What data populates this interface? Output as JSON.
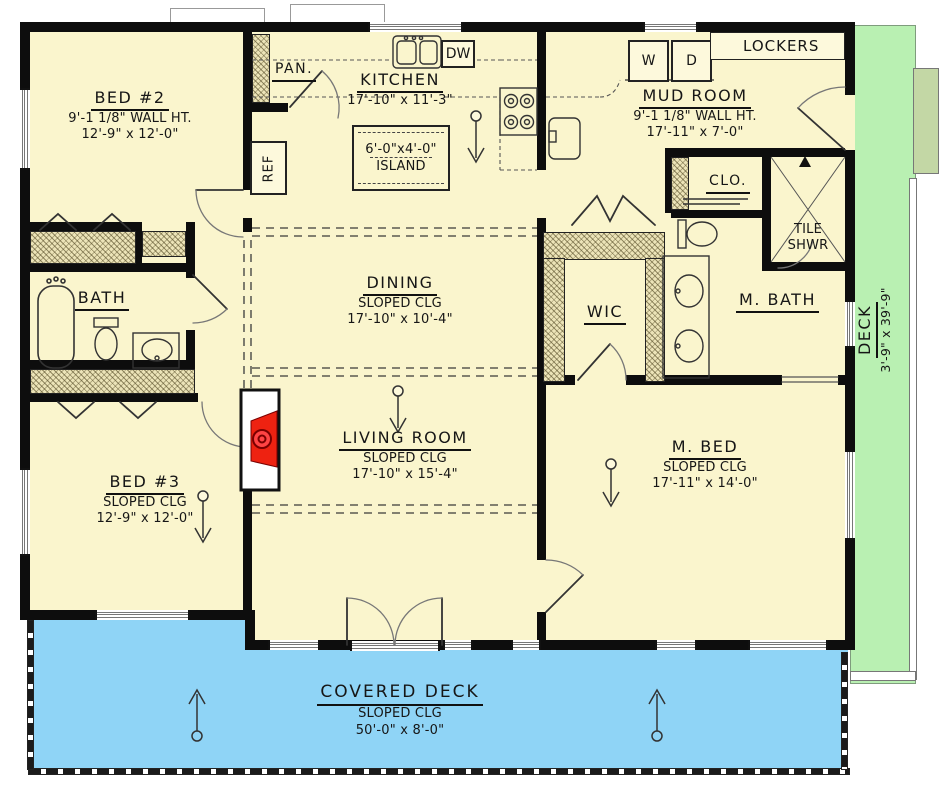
{
  "plan": {
    "title": "One-story house floor plan",
    "colors": {
      "floor": "#faf5cd",
      "wall": "#0d0d0d",
      "deck": "#b9f0b2",
      "deck_step": "#c3d7a5",
      "covered_deck": "#8fd4f6",
      "fireplace": "#ee2211",
      "hatch": "#ece4b8"
    },
    "rooms": {
      "bed2": {
        "name": "BED #2",
        "line1": "9'-1 1/8\" WALL HT.",
        "line2": "12'-9\" x 12'-0\""
      },
      "kitchen": {
        "name": "KITCHEN",
        "line1": "17'-10\" x 11'-3\""
      },
      "island": {
        "line1": "6'-0\"x4'-0\"",
        "line2": "ISLAND"
      },
      "mudroom": {
        "name": "MUD ROOM",
        "line1": "9'-1 1/8\" WALL HT.",
        "line2": "17'-11\" x 7'-0\""
      },
      "dining": {
        "name": "DINING",
        "line1": "SLOPED CLG",
        "line2": "17'-10\" x 10'-4\""
      },
      "living": {
        "name": "LIVING ROOM",
        "line1": "SLOPED CLG",
        "line2": "17'-10\" x 15'-4\""
      },
      "bed3": {
        "name": "BED #3",
        "line1": "SLOPED CLG",
        "line2": "12'-9\" x 12'-0\""
      },
      "mbed": {
        "name": "M. BED",
        "line1": "SLOPED CLG",
        "line2": "17'-11\" x 14'-0\""
      },
      "bath": {
        "name": "BATH"
      },
      "mbath": {
        "name": "M. BATH"
      },
      "wic": {
        "name": "WIC"
      },
      "clo": {
        "name": "CLO."
      },
      "pan": {
        "name": "PAN."
      },
      "tile_shwr": {
        "line1": "TILE",
        "line2": "SHWR"
      },
      "deck": {
        "name": "DECK",
        "line1": "3'-9\" x 39'-9\""
      },
      "covered_deck": {
        "name": "COVERED DECK",
        "line1": "SLOPED CLG",
        "line2": "50'-0\" x 8'-0\""
      }
    },
    "fixtures": {
      "ref": "REF",
      "dw": "DW",
      "washer": "W",
      "dryer": "D",
      "lockers": "LOCKERS"
    }
  }
}
